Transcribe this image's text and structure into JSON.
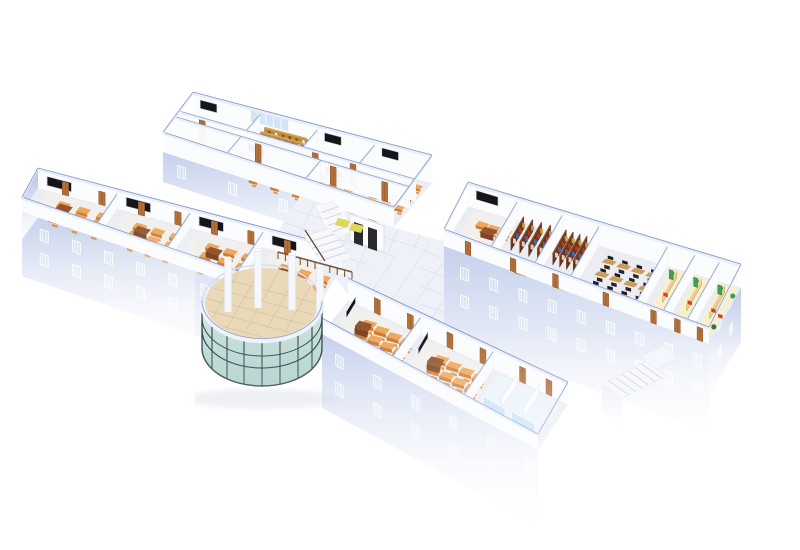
{
  "meta": {
    "description": "3D isometric cutaway rendering of a school building top floor, viewed from above at an angle, on a plain white background with distance fog fading the lower storeys",
    "background": "#ffffff",
    "no_visible_text": true
  },
  "palette": {
    "background": "#ffffff",
    "wall-top": "#e9eefb",
    "wall-edge": "#8496c5",
    "wall-face": "#fbfcfe",
    "floor": "#ebedf3",
    "floor-warm": "#f4f1ea",
    "corridor": "#eff1f7",
    "slab": "#eef1f7",
    "tile-line": "#d8dde8",
    "facade": "#c5d0ec",
    "facade-dark": "#b2bfe3",
    "window-frame": "#ffffff",
    "window-glass": "#c2d9ec",
    "desk-top": "#efa75d",
    "desk-front": "#cd7d36",
    "chair": "#e0913f",
    "teacher-desk": "#7c4523",
    "teacher-desk-top": "#95552c",
    "blackboard": "#15151a",
    "board-frame": "#c9cfdb",
    "door": "#b4713a",
    "door-dark": "#8a4c21",
    "shelf": "#6e3418",
    "shelf-top": "#8a4a24",
    "shelf-wood": "#bd8a3f",
    "shelf-wood-top": "#d9a954",
    "book-colors": [
      "#c9a14e",
      "#a93f2e",
      "#3f6bb0",
      "#ddd8c9"
    ],
    "lab-desk": "#cf9a52",
    "lab-chair": "#26262b",
    "monitor": "#1b1d23",
    "canteen-floor": "#f9f0c8",
    "counter": "#e9cd92",
    "counter-front": "#c9a25c",
    "chair-red": "#d5402e",
    "plant": "#3fa04f",
    "plant-dark": "#2e7a3c",
    "wash-floor": "#eaf3fa",
    "glass-partition": "#bfe0f5",
    "atrium-floor": "#ead9b8",
    "atrium-tile": "#d8c6a2",
    "glass": "#c9e0dd",
    "mullion": "#33454e",
    "rim": "#f0f4fa",
    "railing": "#6b4a2c",
    "stair": "#f6f8fc",
    "step": "#cfd6e3",
    "elevator": "#2a2a31",
    "mat-yellow": "#ddd75a",
    "shadow": "#ccd2e0",
    "glaze-band": "#cfe4f4"
  },
  "scene": {
    "wings": [
      {
        "id": "wing-a",
        "label": "north wing - double-loaded: classrooms and library stack room around a central corridor",
        "rooms": [
          {
            "row": "back",
            "type": "classroom",
            "desk_rows": 3,
            "desk_cols": 3,
            "blackboard": true
          },
          {
            "row": "back",
            "type": "library-stacks",
            "shelf_count": 3
          },
          {
            "row": "back",
            "type": "classroom",
            "desk_rows": 3,
            "desk_cols": 3,
            "blackboard": true
          },
          {
            "row": "back",
            "type": "classroom",
            "desk_rows": 3,
            "desk_cols": 3,
            "blackboard": true
          },
          {
            "row": "front",
            "type": "classroom",
            "desk_rows": 2,
            "desk_cols": 3,
            "blackboard": true
          },
          {
            "row": "front",
            "type": "classroom",
            "desk_rows": 2,
            "desk_cols": 3,
            "blackboard": true
          }
        ],
        "back_glazing": true
      },
      {
        "id": "wing-b",
        "label": "west wing - four classrooms with corridor doors along the back wall",
        "rooms": [
          {
            "type": "classroom",
            "desk_rows": 3,
            "desk_cols": 3,
            "blackboard": true,
            "teacher_desk": true
          },
          {
            "type": "classroom",
            "desk_rows": 3,
            "desk_cols": 3,
            "blackboard": true,
            "teacher_desk": true
          },
          {
            "type": "classroom",
            "desk_rows": 3,
            "desk_cols": 3,
            "blackboard": true,
            "teacher_desk": true
          },
          {
            "type": "classroom",
            "desk_rows": 3,
            "desk_cols": 3,
            "blackboard": true,
            "teacher_desk": true
          }
        ]
      },
      {
        "id": "wing-c",
        "label": "east wing - classroom, two library rooms, computer lab and warm-lit canteen offices",
        "rooms": [
          {
            "type": "classroom",
            "desk_rows": 2,
            "desk_cols": 3,
            "blackboard": true,
            "teacher_desk": true
          },
          {
            "type": "library-stacks",
            "shelf_count": 4
          },
          {
            "type": "library-stacks",
            "shelf_count": 4
          },
          {
            "type": "computer-lab",
            "desk_rows": 3,
            "desk_cols": 4
          },
          {
            "type": "canteen",
            "features": [
              "wood counter",
              "red chair",
              "plants",
              "green cabinet"
            ]
          },
          {
            "type": "canteen",
            "features": [
              "wood counter",
              "red chair",
              "plants",
              "green cabinet"
            ]
          },
          {
            "type": "canteen",
            "features": [
              "wood counter",
              "red chair",
              "plants",
              "green cabinet"
            ]
          }
        ]
      },
      {
        "id": "wing-d",
        "label": "south wing - two classrooms and washrooms with glass partitions",
        "rooms": [
          {
            "type": "classroom",
            "desk_rows": 3,
            "desk_cols": 4,
            "blackboard": true,
            "teacher_desk": true
          },
          {
            "type": "classroom",
            "desk_rows": 3,
            "desk_cols": 4,
            "blackboard": true,
            "teacher_desk": true
          },
          {
            "type": "washrooms",
            "features": [
              "glass partitions",
              "pale blue floor"
            ]
          }
        ]
      }
    ],
    "atrium": {
      "label": "circular glass atrium entrance hall",
      "features": [
        "curved glass curtain wall with dark mullions",
        "white ring beam",
        "beige tiled floor",
        "white columns",
        "balcony railing",
        "interior staircase"
      ]
    },
    "junction": {
      "label": "central circulation core",
      "features": [
        "staircase",
        "two elevator doors",
        "yellow floor mats"
      ]
    },
    "exterior": {
      "features": [
        "external staircase at south-east",
        "lavender facades with window rows",
        "white distance fog at base"
      ]
    }
  }
}
